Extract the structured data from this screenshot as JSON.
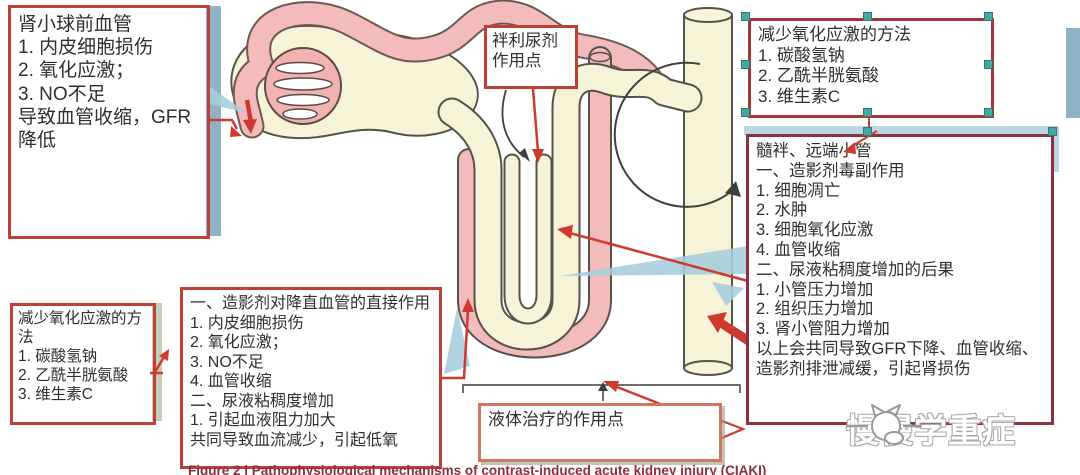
{
  "page": {
    "caption": "Figure 2 | Pathophysiological mechanisms of contrast-induced acute kidney injury (CIAKI)",
    "watermark_text": "慢慢学重症"
  },
  "boxes": {
    "preglomerular_vessels": {
      "lines": [
        "肾小球前血管",
        "1. 内皮细胞损伤",
        "2. 氧化应激；",
        "3. NO不足",
        "导致血管收缩，GFR降低"
      ]
    },
    "loop_diuretic_site": {
      "lines": [
        "袢利尿剂",
        "作用点"
      ]
    },
    "reduce_oxidative_stress_top": {
      "lines": [
        "减少氧化应激的方法",
        "1. 碳酸氢钠",
        "2. 乙酰半胱氨酸",
        "3. 维生素C"
      ]
    },
    "medullary_loop_distal_tubule": {
      "lines": [
        "髓袢、远端小管",
        "一、造影剂毒副作用",
        "1. 细胞凋亡",
        "2. 水肿",
        "3. 细胞氧化应激",
        "4. 血管收缩",
        "二、尿液粘稠度增加的后果",
        "1. 小管压力增加",
        "2. 组织压力增加",
        "3. 肾小管阻力增加",
        "以上会共同导致GFR下降、血管收缩、造影剂排泄减缓，引起肾损伤"
      ]
    },
    "reduce_oxidative_stress_bottom": {
      "lines": [
        "减少氧化应激的方法",
        "1. 碳酸氢钠",
        "2. 乙酰半胱氨酸",
        "3. 维生素C"
      ]
    },
    "contrast_vasa_recta_effect": {
      "lines": [
        "一、造影剂对降直血管的直接作用",
        "1. 内皮细胞损伤",
        "2. 氧化应激；",
        "3. NO不足",
        "4. 血管收缩",
        "二、尿液粘稠度增加",
        "1. 引起血液阻力加大",
        "共同导致血流减少，引起低氧"
      ]
    },
    "fluid_therapy_site": {
      "lines": [
        "液体治疗的作用点"
      ]
    }
  },
  "colors": {
    "box_border_red": "#bf4036",
    "dark_box_border": "#8e2f3e",
    "tube_pink": "#f3bcba",
    "tube_cream": "#f6f3d7",
    "teal_arrow": "#a6cddd",
    "red_arrow": "#cf3a30",
    "selection_teal": "#45a8a2",
    "steel_bar": "#8fb3c5"
  }
}
